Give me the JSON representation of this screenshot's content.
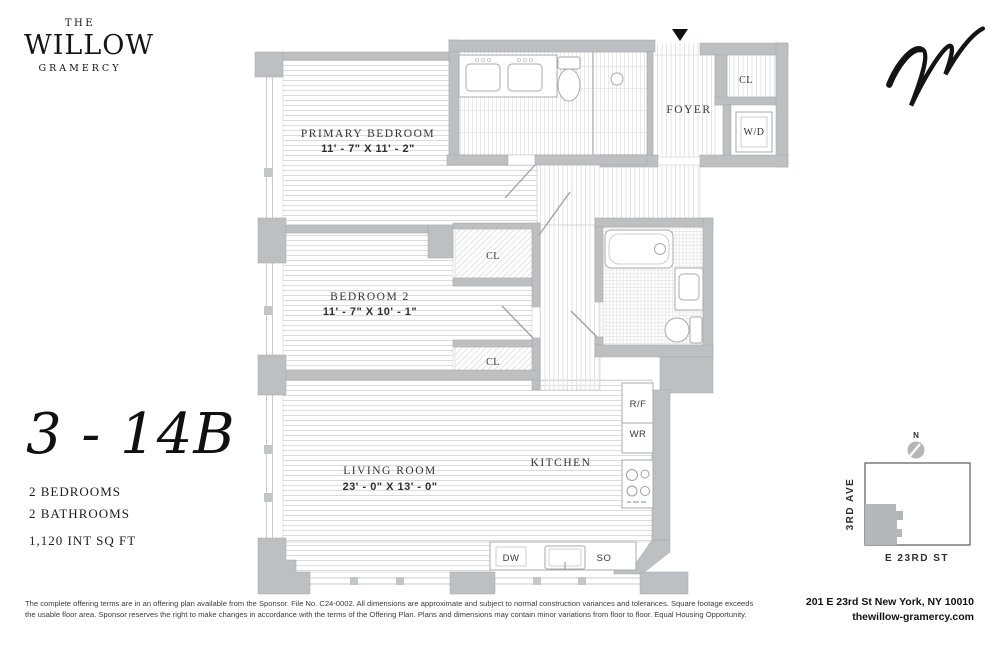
{
  "colors": {
    "wall_gray": "#bcc0c2",
    "brand_black": "#141414",
    "floor_line": "#d9dbdc"
  },
  "brand": {
    "prefix": "THE",
    "name": "WILLOW",
    "location": "GRAMERCY"
  },
  "monogram": "W",
  "unit": {
    "number": "3 - 14B",
    "bedrooms": "2 BEDROOMS",
    "bathrooms": "2 BATHROOMS",
    "area": "1,120 INT SQ FT"
  },
  "plan": {
    "primary_bedroom": {
      "name": "PRIMARY BEDROOM",
      "dims": "11' - 7\" X 11' - 2\""
    },
    "bedroom_2": {
      "name": "BEDROOM 2",
      "dims": "11' - 7\" X 10' - 1\""
    },
    "living_room": {
      "name": "LIVING ROOM",
      "dims": "23' - 0\" X 13' - 0\""
    },
    "kitchen": "KITCHEN",
    "foyer": "FOYER",
    "closet_foyer": "CL",
    "closet_bedroom2_upper": "CL",
    "closet_bedroom2_lower": "CL",
    "washer_dryer": "W/D",
    "refrigerator": "R/F",
    "wine_refrigerator": "WR",
    "dishwasher": "DW",
    "stove_oven": "SO"
  },
  "map": {
    "north": "N",
    "avenue": "3RD AVE",
    "street": "E 23RD ST"
  },
  "footer": {
    "disclaimer_line1": "The complete offering terms are in an offering plan available from the Sponsor. File No. C24-0002.   All dimensions are approximate and subject to normal construction variances and tolerances. Square footage exceeds",
    "disclaimer_line2": "the usable floor area. Sponsor reserves the right to make changes in accordance with the terms of the Offering Plan. Plans and dimensions may contain minor variations from floor to floor.  Equal Housing Opportunity.",
    "address": "201 E 23rd St New York, NY 10010",
    "website": "thewillow-gramercy.com"
  }
}
